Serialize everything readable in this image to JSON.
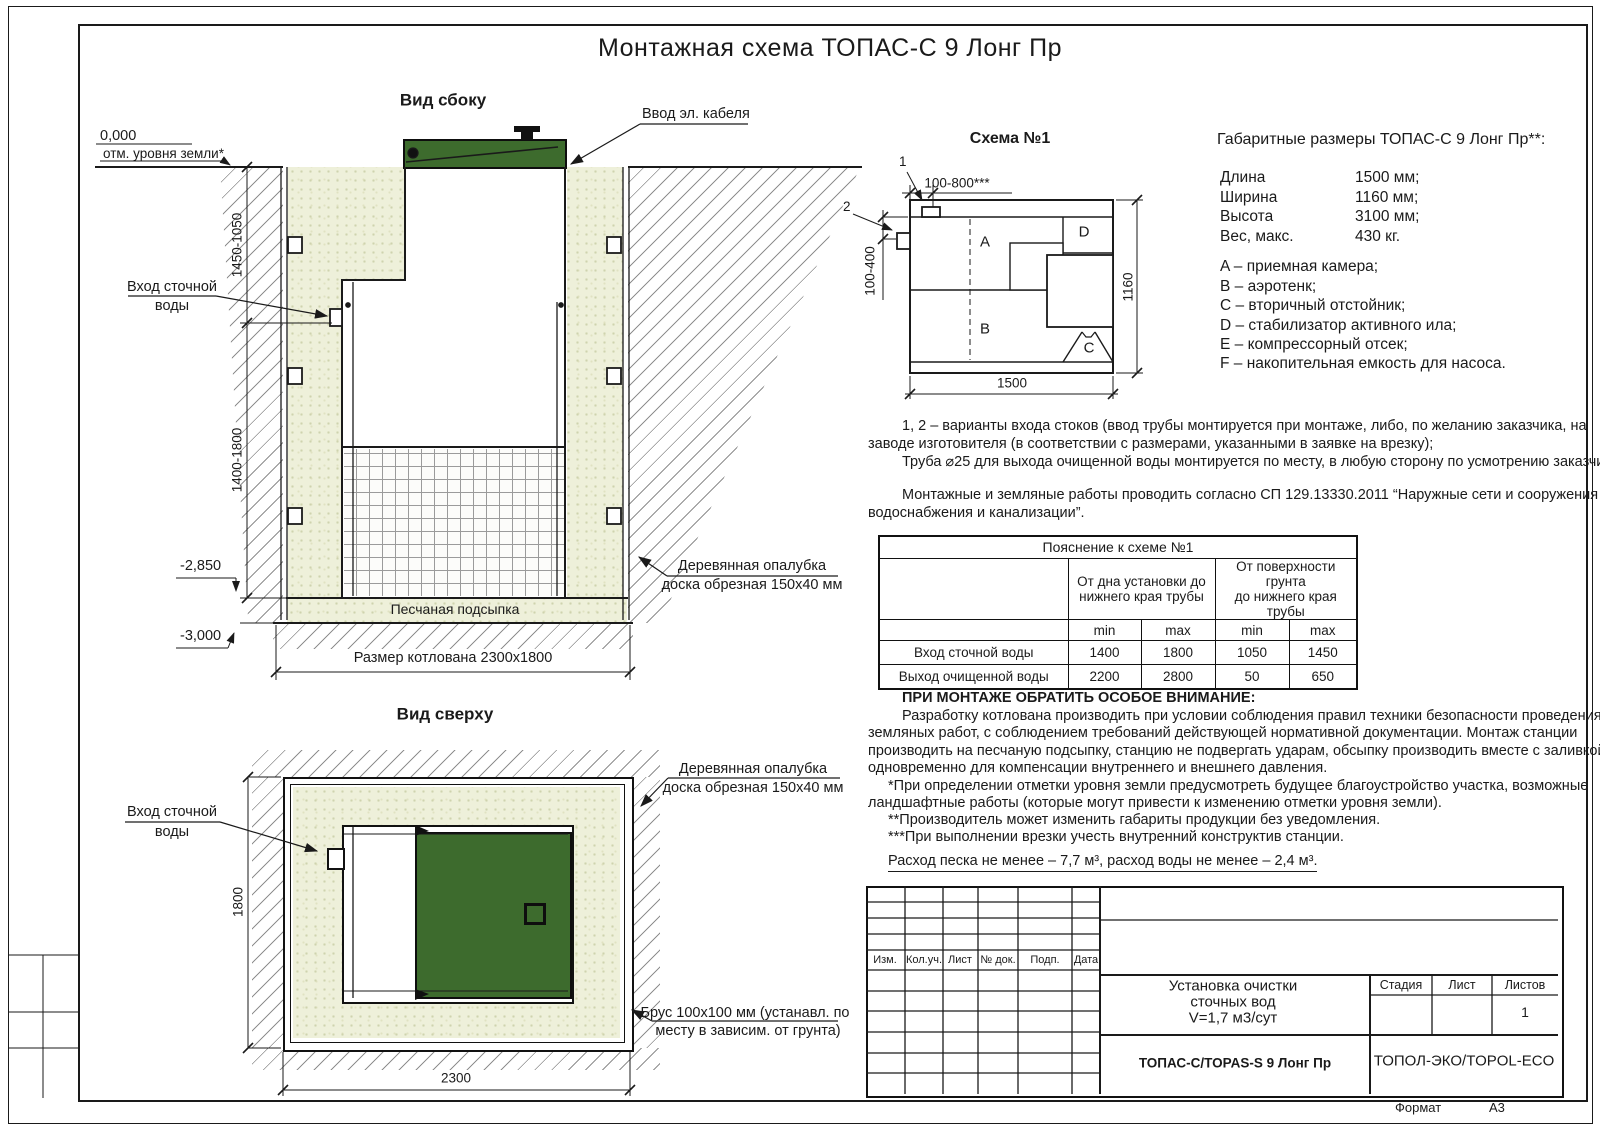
{
  "sheet": {
    "title": "Монтажная схема ТОПАС-С 9 Лонг Пр",
    "format_label": "Формат",
    "format_value": "А3"
  },
  "side_view": {
    "title": "Вид сбоку",
    "level_zero": "0,000",
    "level_zero_note": "отм. уровня земли*",
    "level_m285": "-2,850",
    "level_m300": "-3,000",
    "dim_upper": "1450-1050",
    "dim_lower": "1400-1800",
    "inlet_line1": "Вход сточной",
    "inlet_line2": "воды",
    "cable_label": "Ввод эл. кабеля",
    "formwork_line1": "Деревянная опалубка",
    "formwork_line2": "доска обрезная 150x40 мм",
    "sand_bed": "Песчаная подсыпка",
    "pit_size": "Размер котлована 2300x1800"
  },
  "top_view": {
    "title": "Вид сверху",
    "inlet_line1": "Вход сточной",
    "inlet_line2": "воды",
    "formwork_line1": "Деревянная опалубка",
    "formwork_line2": "доска обрезная 150x40 мм",
    "beam_line1": "Брус 100x100 мм (устанавл. по",
    "beam_line2": "месту в зависим. от грунта)",
    "dim_width": "1800",
    "dim_length": "2300"
  },
  "schema1": {
    "title": "Схема №1",
    "marker1": "1",
    "marker2": "2",
    "dim_top": "100-800***",
    "dim_left": "100-400",
    "dim_right": "1160",
    "dim_bottom": "1500",
    "comp_a": "A",
    "comp_b": "B",
    "comp_c": "C",
    "comp_d": "D",
    "comp_e": "E",
    "comp_f": "F"
  },
  "specs": {
    "title": "Габаритные размеры ТОПАС-С 9 Лонг Пр**:",
    "rows": [
      {
        "k": "Длина",
        "v": "1500 мм;"
      },
      {
        "k": "Ширина",
        "v": "1160 мм;"
      },
      {
        "k": "Высота",
        "v": "3100 мм;"
      },
      {
        "k": "Вес, макс.",
        "v": "430 кг."
      }
    ],
    "legend": [
      "A – приемная камера;",
      "B – аэротенк;",
      "C – вторичный отстойник;",
      "D – стабилизатор активного ила;",
      "E – компрессорный отсек;",
      "F – накопительная емкость для насоса."
    ]
  },
  "notes": {
    "p1a": "1, 2 – варианты входа  стоков (ввод трубы монтируется при монтаже, либо, по желанию заказчика, на",
    "p1b": "заводе изготовителя (в соответствии с размерами, указанными в заявке на врезку);",
    "p1c": "Труба ⌀25 для выхода очищенной воды монтируется по месту, в любую сторону по усмотрению заказчика.",
    "p2a": "Монтажные и земляные работы проводить согласно СП 129.13330.2011 “Наружные сети и сооружения",
    "p2b": "водоснабжения и канализации”."
  },
  "table": {
    "title": "Пояснение к схеме №1",
    "h1a": "От дна установки до",
    "h1b": "нижнего края трубы",
    "h2a": "От поверхности грунта",
    "h2b": "до нижнего края трубы",
    "min": "min",
    "max": "max",
    "rows": [
      {
        "label": "Вход сточной воды",
        "v": [
          "1400",
          "1800",
          "1050",
          "1450"
        ]
      },
      {
        "label": "Выход очищенной воды",
        "v": [
          "2200",
          "2800",
          "50",
          "650"
        ]
      }
    ]
  },
  "warning": {
    "title": "ПРИ МОНТАЖЕ ОБРАТИТЬ ОСОБОЕ ВНИМАНИЕ:",
    "lines": [
      "Разработку котлована производить при условии соблюдения правил техники безопасности проведения",
      "земляных работ, с соблюдением требований действующей нормативной документации. Монтаж станции",
      "производить на песчаную подсыпку, станцию не подвергать ударам, обсыпку производить вместе с заливкой",
      "одновременно для компенсации внутреннего и внешнего давления."
    ]
  },
  "footnotes": [
    "*При определении отметки уровня земли предусмотреть будущее благоустройство участка, возможные",
    "ландшафтные работы (которые могут привести к изменению отметки уровня земли).",
    "**Производитель может изменить габариты продукции без уведомления.",
    "***При выполнении врезки учесть внутренний конструктив станции."
  ],
  "consumption": "Расход песка не менее – 7,7 м³, расход воды не менее – 2,4 м³.",
  "title_block": {
    "cols": [
      "Изм.",
      "Кол.уч.",
      "Лист",
      "№ док.",
      "Подп.",
      "Дата"
    ],
    "doc1": "Установка очистки",
    "doc2": "сточных вод",
    "doc3": "V=1,7 м3/сут",
    "stage_label": "Стадия",
    "sheet_label": "Лист",
    "sheets_label": "Листов",
    "sheets_value": "1",
    "model": "ТОПАС-С/TOPAS-S 9 Лонг Пр",
    "company": "ТОПОЛ-ЭКО/TOPOL-ECO"
  },
  "colors": {
    "lid_green": "#3d6b2d",
    "line": "#1a1a1a",
    "sand": "#eef0da"
  }
}
